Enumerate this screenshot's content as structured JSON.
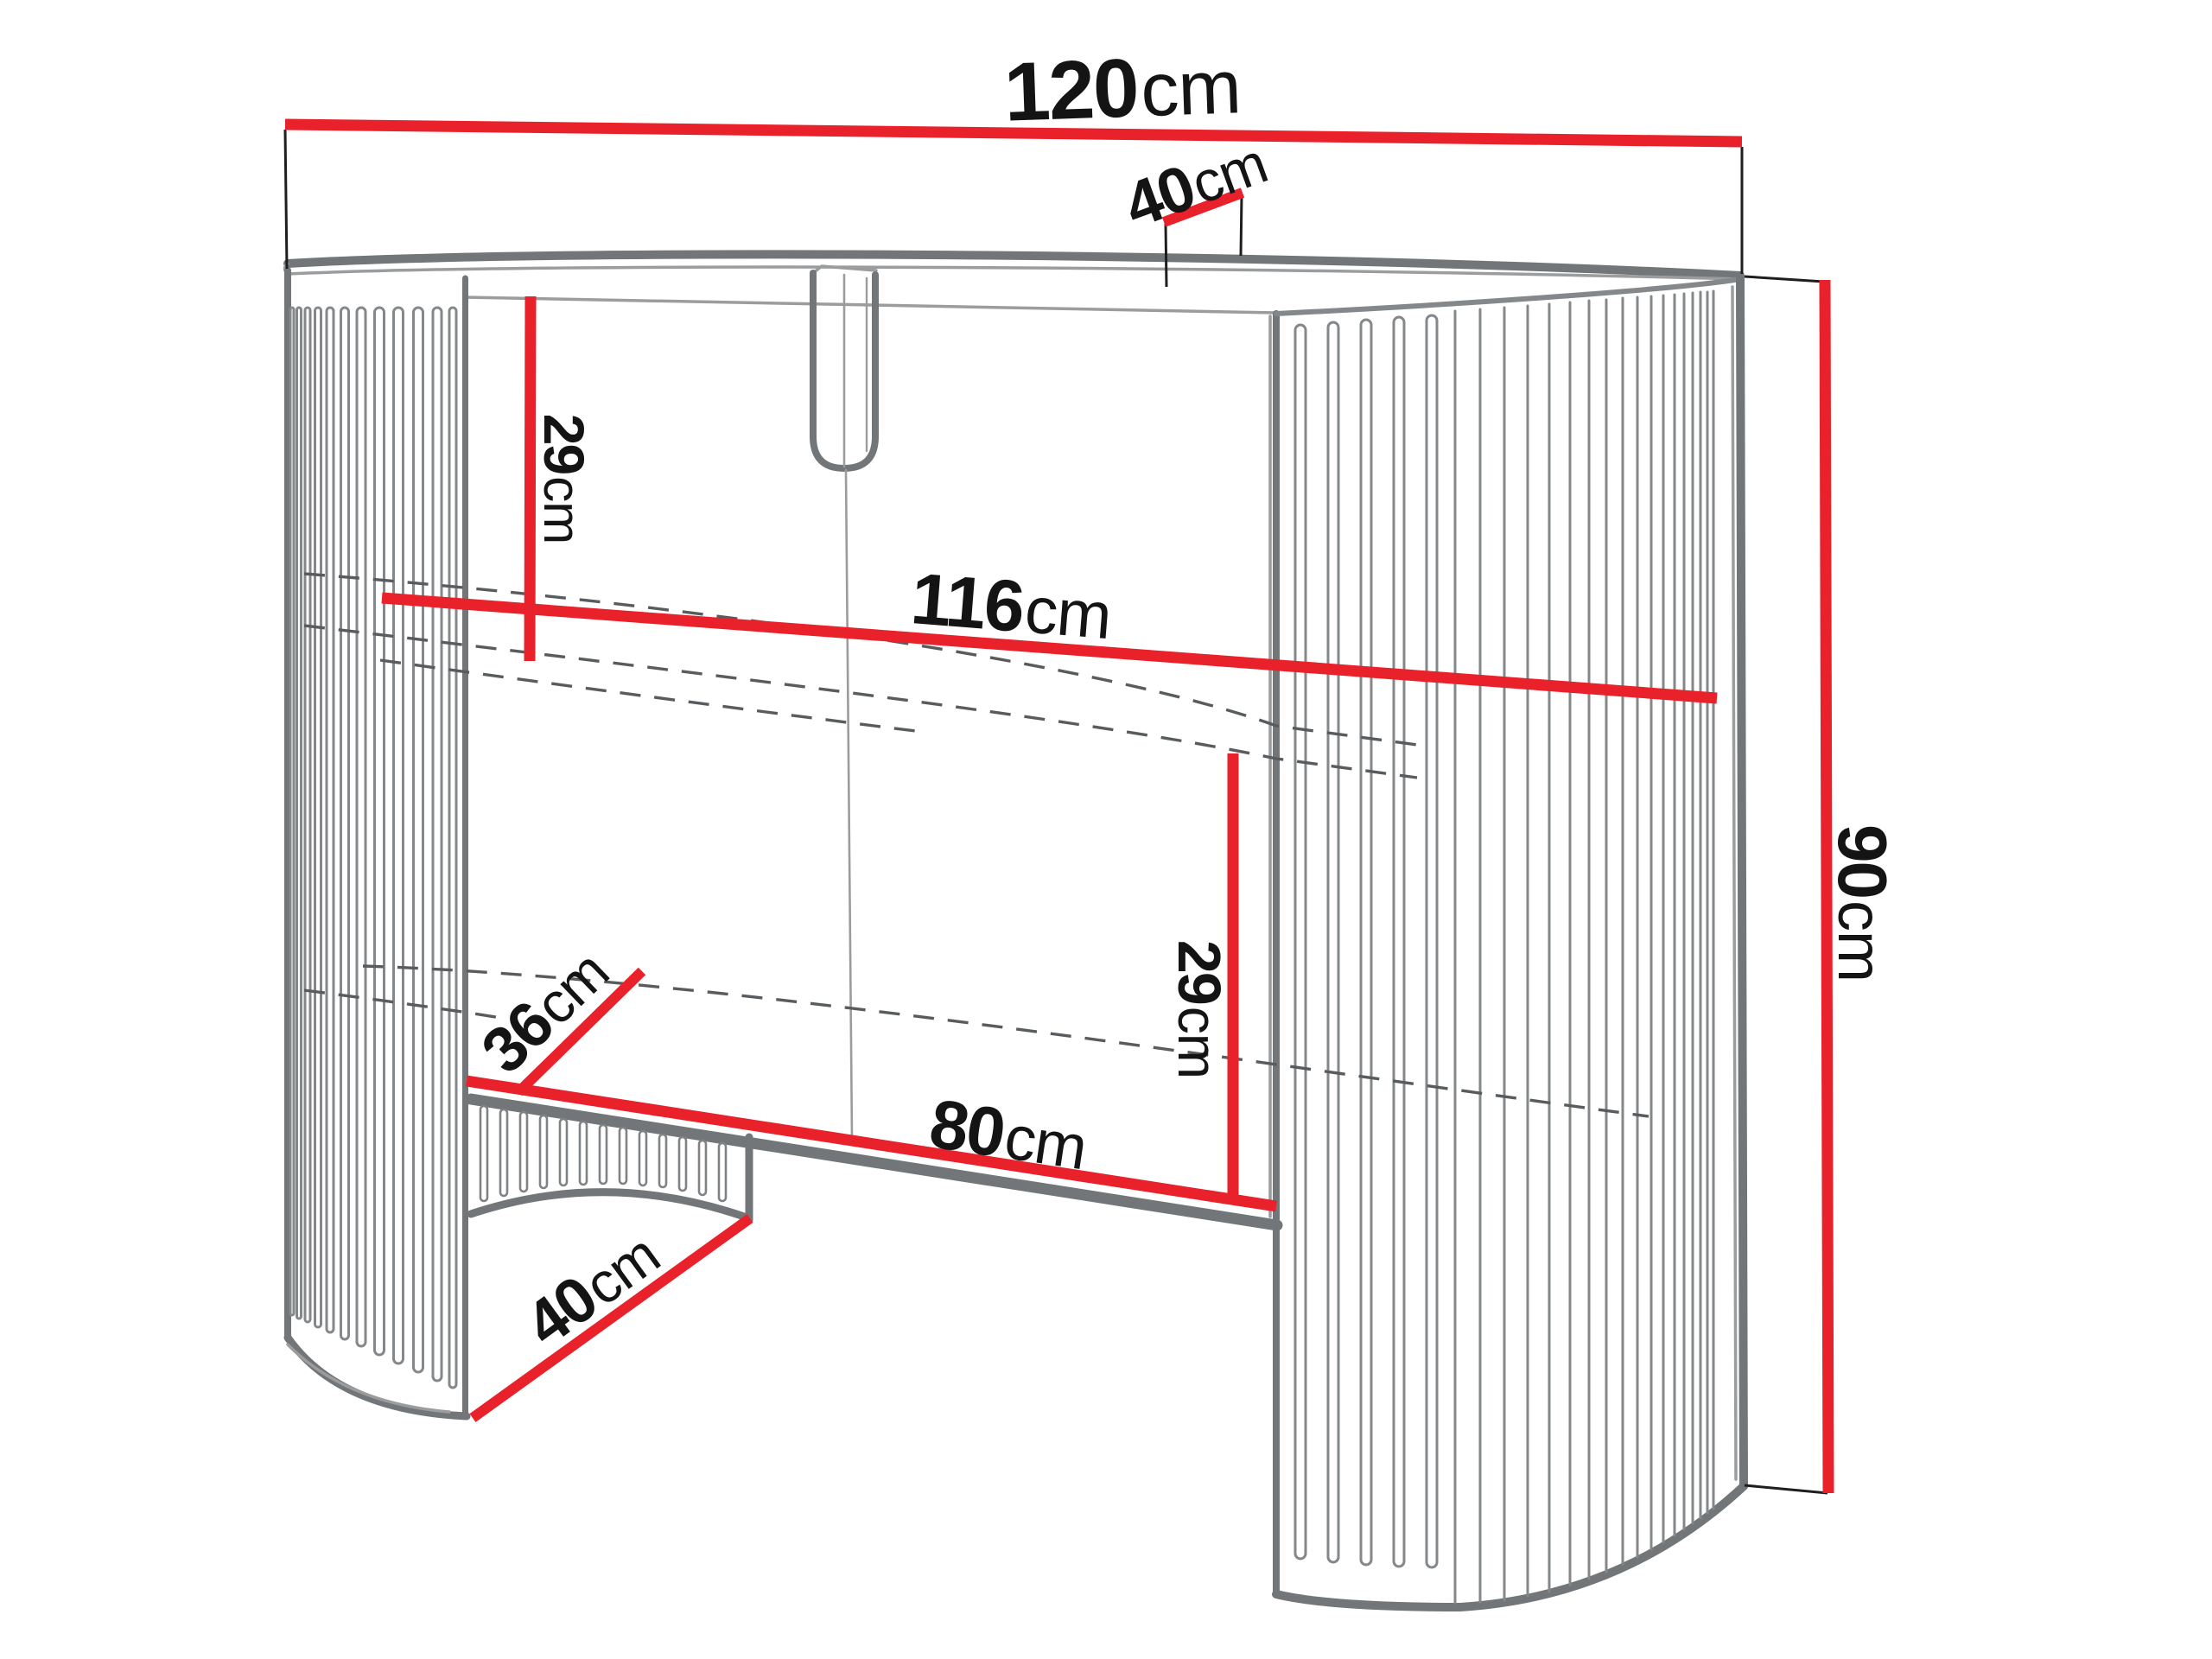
{
  "diagram": {
    "type": "furniture-dimension-diagram",
    "subject": "fluted console dressing table, front perspective line drawing",
    "units": "cm"
  },
  "colors": {
    "dimension_line": "#e8212b",
    "extension_line": "#1e1e1e",
    "outline": "#737678",
    "hidden_line": "#595c5e",
    "label_text": "#141414",
    "background": "#ffffff"
  },
  "dims": [
    {
      "name": "top-width",
      "value": "120",
      "unit": "cm"
    },
    {
      "name": "top-depth",
      "value": "40",
      "unit": "cm"
    },
    {
      "name": "upper-clearance",
      "value": "29",
      "unit": "cm"
    },
    {
      "name": "inner-width",
      "value": "116",
      "unit": "cm"
    },
    {
      "name": "total-height",
      "value": "90",
      "unit": "cm"
    },
    {
      "name": "shelf-depth",
      "value": "36",
      "unit": "cm"
    },
    {
      "name": "lower-clearance",
      "value": "29",
      "unit": "cm"
    },
    {
      "name": "opening-width",
      "value": "80",
      "unit": "cm"
    },
    {
      "name": "base-depth",
      "value": "40",
      "unit": "cm"
    }
  ]
}
